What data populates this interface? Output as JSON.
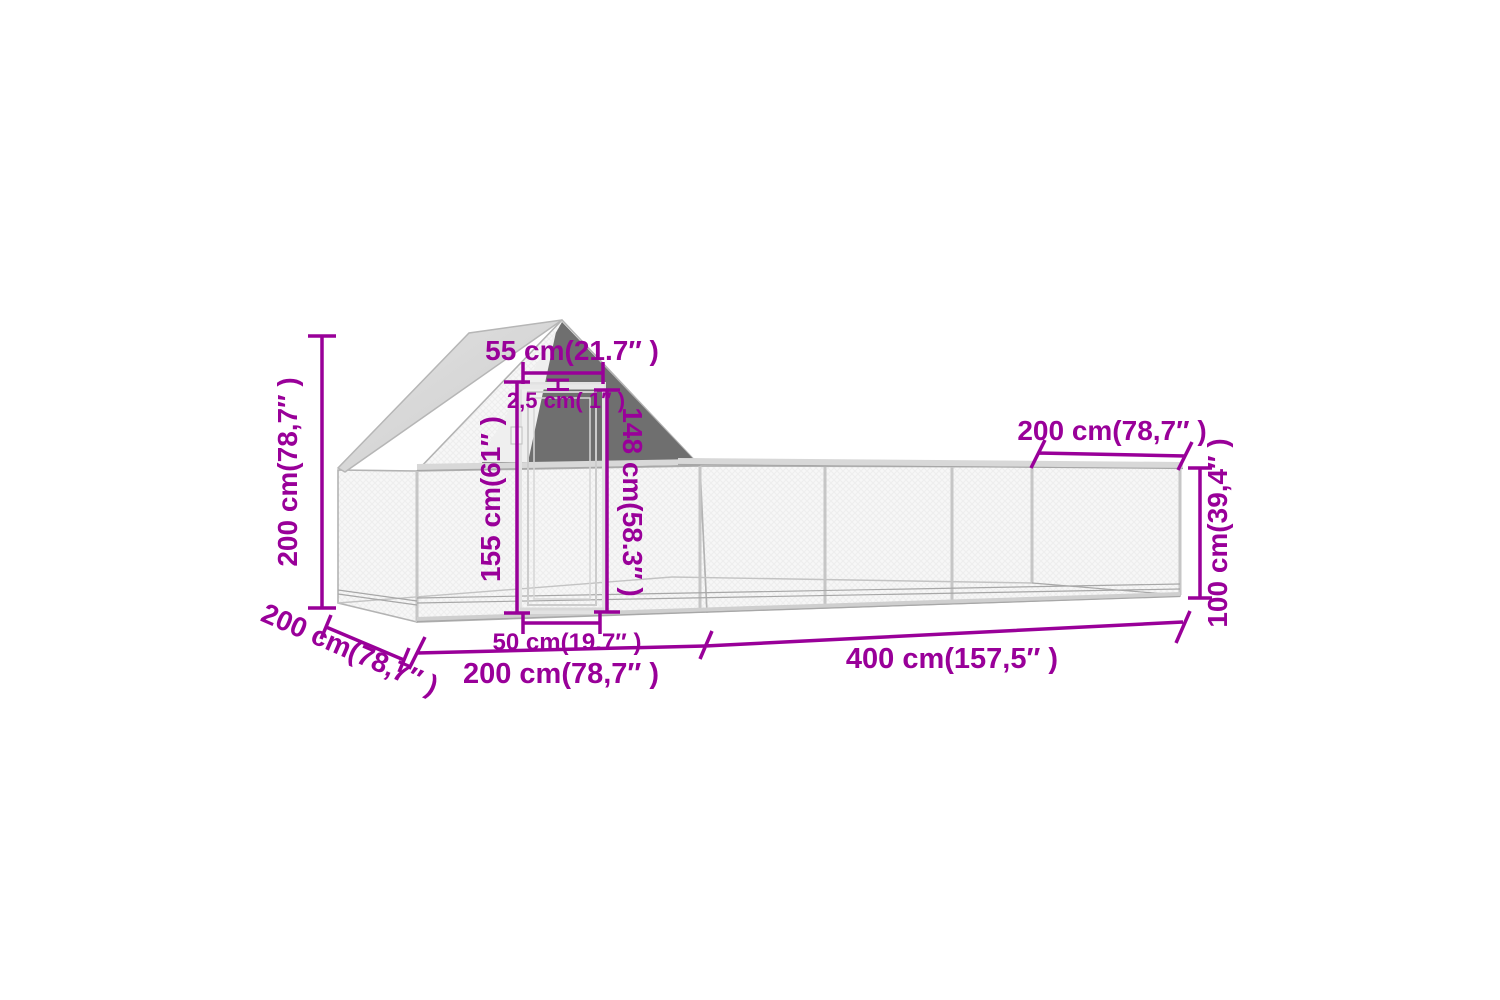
{
  "colors": {
    "dimension": "#990099",
    "roofLight": "#d9d9d9",
    "roofDark": "#6f6f6f",
    "frameLine": "#b3b3b3",
    "wallFill": "#f7f7f7",
    "background": "#ffffff"
  },
  "dimensions": {
    "total_height": "200 cm(78,7″ )",
    "gable_top_width": "55 cm(21.7″ )",
    "frame_thickness": "2,5 cm( 1″ )",
    "door_height": "155 cm(61″ )",
    "door_opening_height": "148 cm(58.3″ )",
    "door_width": "50 cm(19.7″ )",
    "coop_depth": "200 cm(78,7″ )",
    "coop_length": "200 cm(78,7″ )",
    "run_length": "400 cm(157,5″ )",
    "run_top_depth": "200 cm(78,7″ )",
    "run_height": "100 cm(39,4″ )"
  }
}
